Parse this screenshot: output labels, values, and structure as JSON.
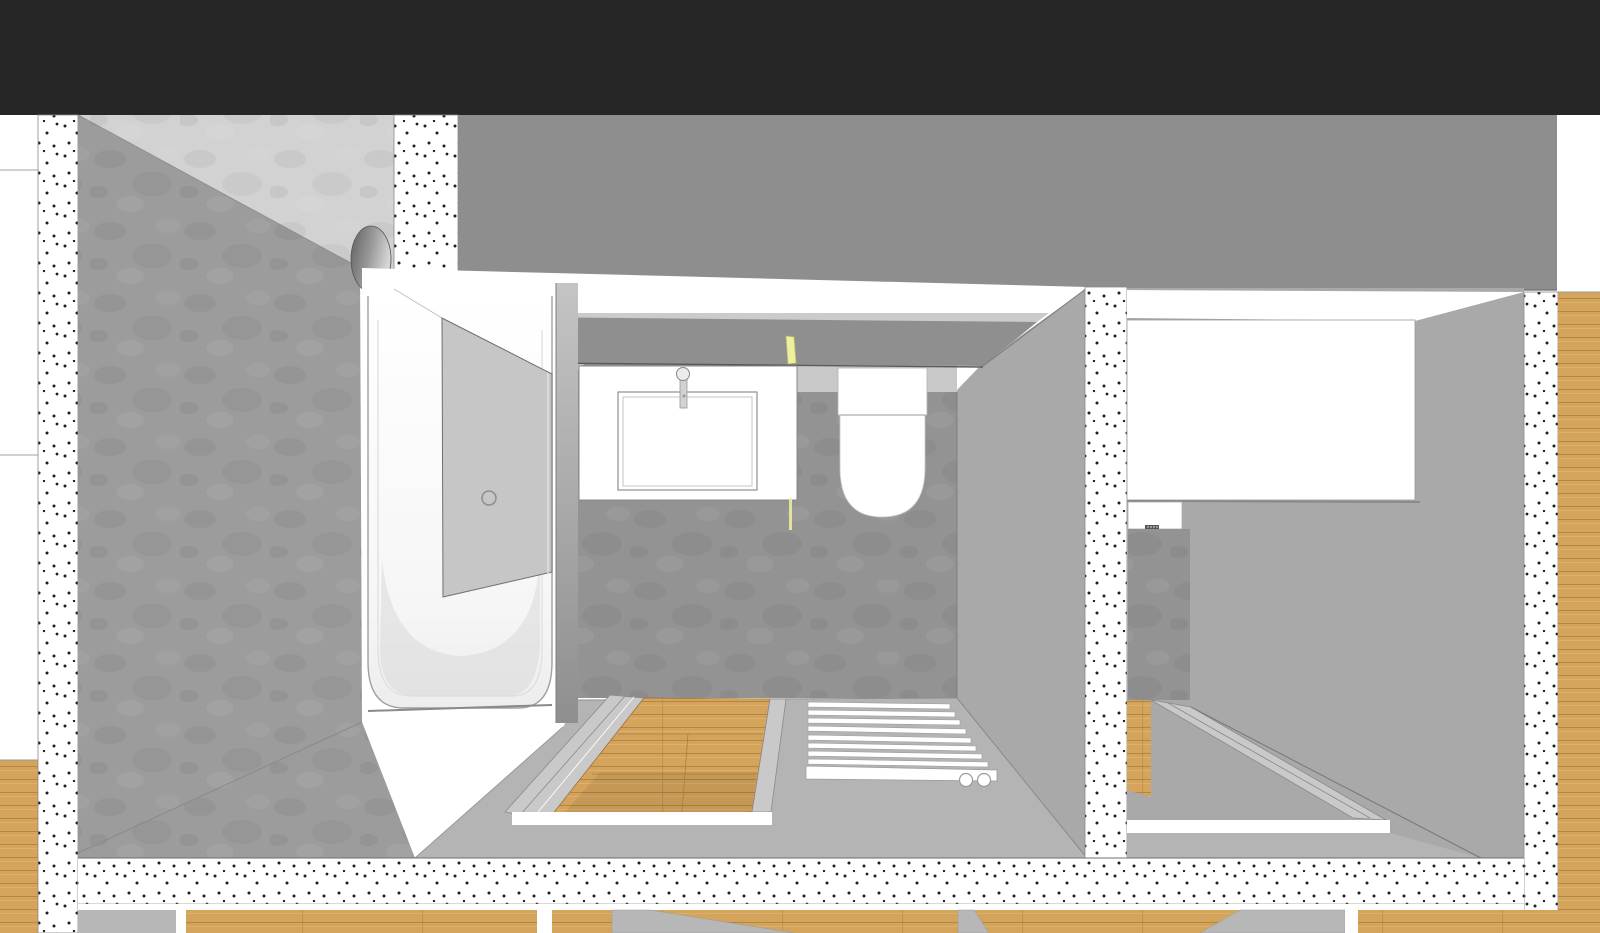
{
  "app": {
    "header_title": ""
  },
  "canvas": {
    "width": 1600,
    "height": 933
  },
  "scene": {
    "view": "sectional-3d-perspective",
    "rooms": [
      "bathroom",
      "adjacent-bathroom"
    ],
    "fixtures": [
      "bathtub",
      "shower-screen",
      "vanity-sink",
      "faucet",
      "wall-hung-toilet",
      "towel-radiator",
      "led-cove-lights",
      "sunken-wood-pit",
      "mirror-cabinet"
    ]
  },
  "colors": {
    "header": "#262626",
    "white": "#ffffff",
    "upper_band": "#8e8e8e",
    "band_edge": "#6e6e6e",
    "wall_texture": "#9c9c9c",
    "wall_texture_light": "#d2d2d2",
    "back_wall": "#939393",
    "back_wall_light": "#c8c8c8",
    "side_wall": "#a9a9a9",
    "ceiling_panel": "#8f8f8f",
    "ceiling_strip": "#cbcbcb",
    "ceiling_slope": "#b4b4b4",
    "ceiling_edge": "#5a5a5a",
    "led": "#eef0a0",
    "led_edge": "#bdbd72",
    "floor": "#b4b4b4",
    "rim": "#c9c9c9",
    "door_panel": "#c6c6c6",
    "outline": "#6f6f6f",
    "line_soft": "#9a9a9a",
    "wood": "#d5a45c",
    "wood_line": "#a87f3c",
    "wood_light": "#e3bd7d",
    "stipple_dot": "#1f1f1f",
    "knob_dark": "#5f5f5f",
    "knob_light": "#d6d6d6",
    "bottom_gray": "#b7b7b7",
    "slab_gray": "#b5b5b5",
    "tub_shade": "#ededed"
  }
}
